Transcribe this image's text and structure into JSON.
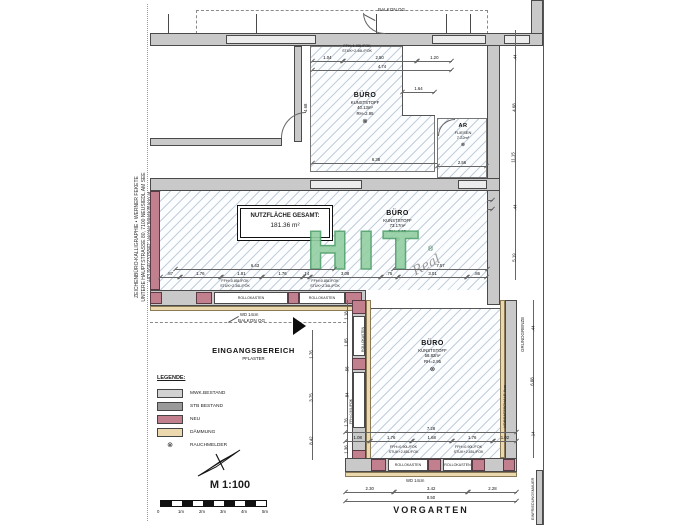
{
  "architect": {
    "line1": "ZEICHENBÜRO-KALLIGRAPHIE  •  WERNER FEKETE",
    "line2": "UNTERE HAUPTSTRASSE 80, 7100 NEUSIEDL AM SEE",
    "line3": "+43 664/2315842, werner.fekete@aon.at"
  },
  "summary_box": {
    "title": "NUTZFLÄCHE GESAMT:",
    "value": "181.36 m²"
  },
  "rooms": {
    "buero_top": {
      "name": "BÜRO",
      "material": "KUNSTSTOFF",
      "area": "40.13m²",
      "height": "RH=2.95",
      "smoke": "⊗"
    },
    "ar": {
      "name": "AR",
      "material": "FLIESEN",
      "area": "7.22m²",
      "smoke": "⊗"
    },
    "buero_mid": {
      "name": "BÜRO",
      "material": "KUNSTSTOFF",
      "area": "73.17m²",
      "height": "RH=2.95",
      "smoke": "⊗"
    },
    "buero_bottom": {
      "name": "BÜRO",
      "material": "KUNSTSTOFF",
      "area": "58.82m²",
      "height": "RH=2.95",
      "smoke": "⊗"
    }
  },
  "areas": {
    "balkon_top": "BALKON OG",
    "balkon_mid": "BALKON OG",
    "eingang_line1": "EINGANGSBEREICH",
    "eingang_line2": "PFLASTER",
    "vorgarten": "VORGARTEN"
  },
  "site": {
    "grundgrenze": "GRUNDGRENZE",
    "vorsatzschale": "VORSATZSCHALE 6cm",
    "einfriedungsmauer": "EINFRIEDUNGSMAUER",
    "wd_a": "WD 14cm",
    "wd_b": "WD 14cm"
  },
  "window_notes": {
    "top": [
      "FFH=1.03L/FOK",
      "STUK+2.46L/FOK"
    ],
    "mid": [
      "FFH=0.85L/FOK",
      "STUK+2.36L/FOK"
    ],
    "bottom": [
      "FFH=0.90L/FOK",
      "STUK+2.85L/FOK"
    ],
    "rollokasten": "ROLLOKASTEN"
  },
  "legend": {
    "title": "LEGENDE:",
    "items": [
      {
        "label": "MWK.BESTAND",
        "color": "#d2d2d2"
      },
      {
        "label": "STB BESTAND",
        "color": "#9a9a9a"
      },
      {
        "label": "NEU",
        "color": "#c2808f"
      },
      {
        "label": "DÄMMUNG",
        "color": "#ecd8ae"
      }
    ],
    "rauchmelder_symbol": "⊗",
    "rauchmelder_label": "RAUCHMELDER"
  },
  "scale": {
    "label": "M 1:100",
    "ticks": [
      "0",
      "1m",
      "2m",
      "3m",
      "4m",
      "5m"
    ]
  },
  "watermark": {
    "text": "HIT",
    "reg": "®",
    "signature": "Real"
  },
  "dims": {
    "top_window": [
      "1.04",
      "2.50",
      "1.20"
    ],
    "top_window_total": "4.74",
    "notch": "1.64",
    "r1_width": "6.38",
    "r1_gap": ".14",
    "r1_height": "4.68",
    "ar_width": "2.56",
    "mid_top": [
      "5.09",
      "1.38",
      ".58",
      "2.77",
      "4.20"
    ],
    "mid_top_total": "14.00",
    "mid_seg_left": "6.43",
    "mid_seg_right": "7.57",
    "mid_bottom": [
      ".87",
      "1.76",
      "1.81",
      "1.76",
      ".14",
      "3.08",
      ".75",
      "3.01",
      ".86"
    ],
    "right_upper": [
      ".44",
      "4.68",
      "11.15",
      ".44",
      "5.19"
    ],
    "right_lower": [
      ".44",
      "6.08",
      ".14"
    ],
    "wall_left_chain": [
      "1.18",
      "1.05",
      ".56",
      ".84",
      "1.76",
      "1.36"
    ],
    "entry_chain": [
      "1.76",
      "3.75",
      "8.42"
    ],
    "bottom_windows_total": "7.28",
    "bottom_windows": [
      "1.08",
      "1.76",
      "1.68",
      "1.76",
      "1.02"
    ],
    "vorgarten_chain": [
      "2.30",
      "3.42",
      "2.28"
    ],
    "vorgarten_total": "8.50"
  }
}
